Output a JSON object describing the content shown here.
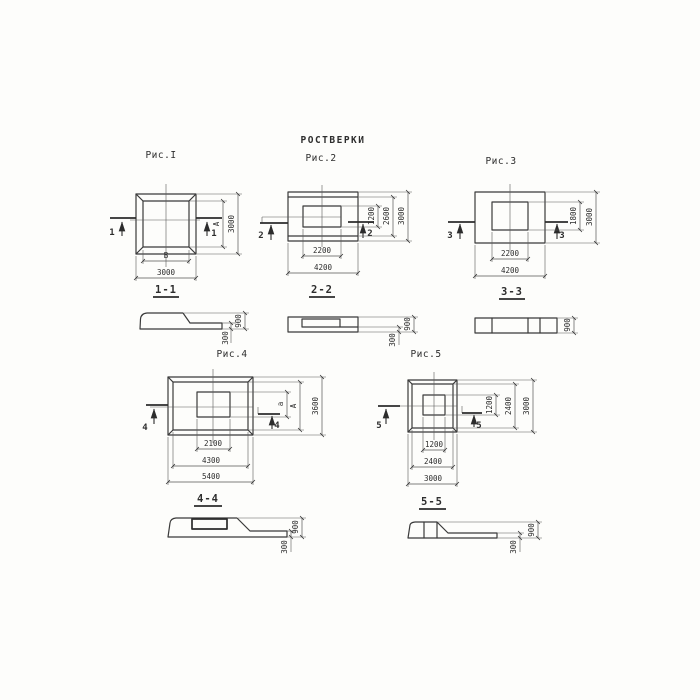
{
  "title": "РОСТВЕРКИ",
  "figures": {
    "fig1": {
      "label": "Рис.I",
      "marker": "1",
      "plan": {
        "inner_width": "В",
        "outer_width": "3000",
        "inner_height": "А",
        "outer_height": "3000"
      },
      "section": {
        "title": "1-1",
        "total_height": "900",
        "flange_height": "300"
      }
    },
    "fig2": {
      "label": "Рис.2",
      "marker": "2",
      "plan": {
        "inner_width": "2200",
        "outer_width": "4200",
        "inner_height": "1200",
        "mid_height": "2600",
        "outer_height": "3000"
      },
      "section": {
        "title": "2-2",
        "total_height": "900",
        "flange_height": "300"
      }
    },
    "fig3": {
      "label": "Рис.3",
      "marker": "3",
      "plan": {
        "inner_width": "2200",
        "outer_width": "4200",
        "inner_height": "1800",
        "outer_height": "3000"
      },
      "section": {
        "title": "3-3",
        "total_height": "900"
      }
    },
    "fig4": {
      "label": "Рис.4",
      "marker": "4",
      "plan": {
        "inner_width": "2100",
        "mid_width": "4300",
        "outer_width": "5400",
        "inner_height": "а",
        "mid_height": "А",
        "outer_height": "3600"
      },
      "section": {
        "title": "4-4",
        "total_height": "900",
        "flange_height": "300"
      }
    },
    "fig5": {
      "label": "Рис.5",
      "marker": "5",
      "plan": {
        "inner_width": "1200",
        "mid_width": "2400",
        "outer_width": "3000",
        "inner_height": "1200",
        "mid_height": "2400",
        "outer_height": "3000"
      },
      "section": {
        "title": "5-5",
        "total_height": "900",
        "flange_height": "300"
      }
    }
  }
}
